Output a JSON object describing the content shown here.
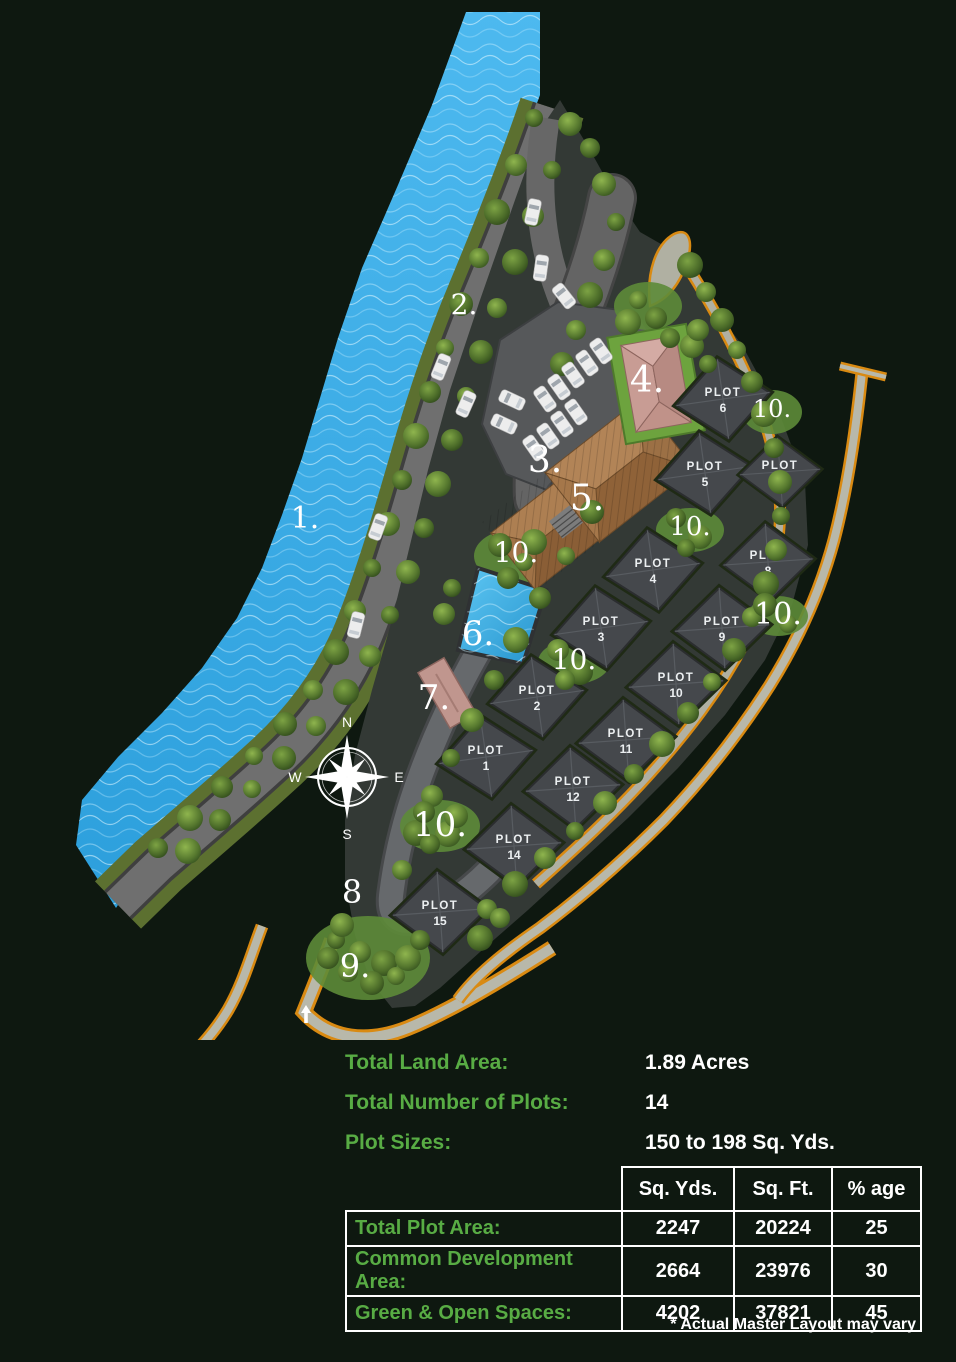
{
  "colors": {
    "background": "#0e1810",
    "accent_green_text": "#58ac44",
    "white_text": "#ffffff",
    "river_blue": "#38a9e2",
    "pool_blue": "#3bb3ea",
    "road_gray": "#6f6f6f",
    "plot_gray": "#45484c",
    "tree_green": "#557a2e",
    "path_edge_orange": "#d98a12",
    "clubhouse_brown": "#a87c4e",
    "building_pink": "#c89c94"
  },
  "map": {
    "compass": {
      "north": "N",
      "east": "E",
      "south": "S",
      "west": "W"
    },
    "plots": [
      {
        "name": "PLOT",
        "number": "6"
      },
      {
        "name": "PLOT",
        "number": "5"
      },
      {
        "name": "PLOT",
        "number": "7"
      },
      {
        "name": "PLOT",
        "number": "4"
      },
      {
        "name": "PLOT",
        "number": "8"
      },
      {
        "name": "PLOT",
        "number": "3"
      },
      {
        "name": "PLOT",
        "number": "9"
      },
      {
        "name": "PLOT",
        "number": "2"
      },
      {
        "name": "PLOT",
        "number": "10"
      },
      {
        "name": "PLOT",
        "number": "1"
      },
      {
        "name": "PLOT",
        "number": "11"
      },
      {
        "name": "PLOT",
        "number": "12"
      },
      {
        "name": "PLOT",
        "number": "14"
      },
      {
        "name": "PLOT",
        "number": "15"
      }
    ],
    "markers": [
      {
        "text": "1."
      },
      {
        "text": "2."
      },
      {
        "text": "3."
      },
      {
        "text": "4."
      },
      {
        "text": "5."
      },
      {
        "text": "6."
      },
      {
        "text": "7."
      },
      {
        "text": "8"
      },
      {
        "text": "9."
      },
      {
        "text": "10."
      },
      {
        "text": "10."
      },
      {
        "text": "10."
      },
      {
        "text": "10."
      },
      {
        "text": "10."
      },
      {
        "text": "10."
      }
    ]
  },
  "info": {
    "rows": [
      {
        "label": "Total Land Area:",
        "value": "1.89 Acres"
      },
      {
        "label": "Total Number of Plots:",
        "value": "14"
      },
      {
        "label": "Plot Sizes:",
        "value": "150 to 198 Sq. Yds."
      }
    ]
  },
  "table": {
    "headers": [
      "Sq. Yds.",
      "Sq. Ft.",
      "% age"
    ],
    "rows": [
      {
        "label": "Total Plot Area:",
        "sq_yds": "2247",
        "sq_ft": "20224",
        "pct": "25"
      },
      {
        "label": "Common Development Area:",
        "sq_yds": "2664",
        "sq_ft": "23976",
        "pct": "30"
      },
      {
        "label": "Green & Open Spaces:",
        "sq_yds": "4202",
        "sq_ft": "37821",
        "pct": "45"
      }
    ]
  },
  "footnote": "* Actual Master Layout may vary"
}
